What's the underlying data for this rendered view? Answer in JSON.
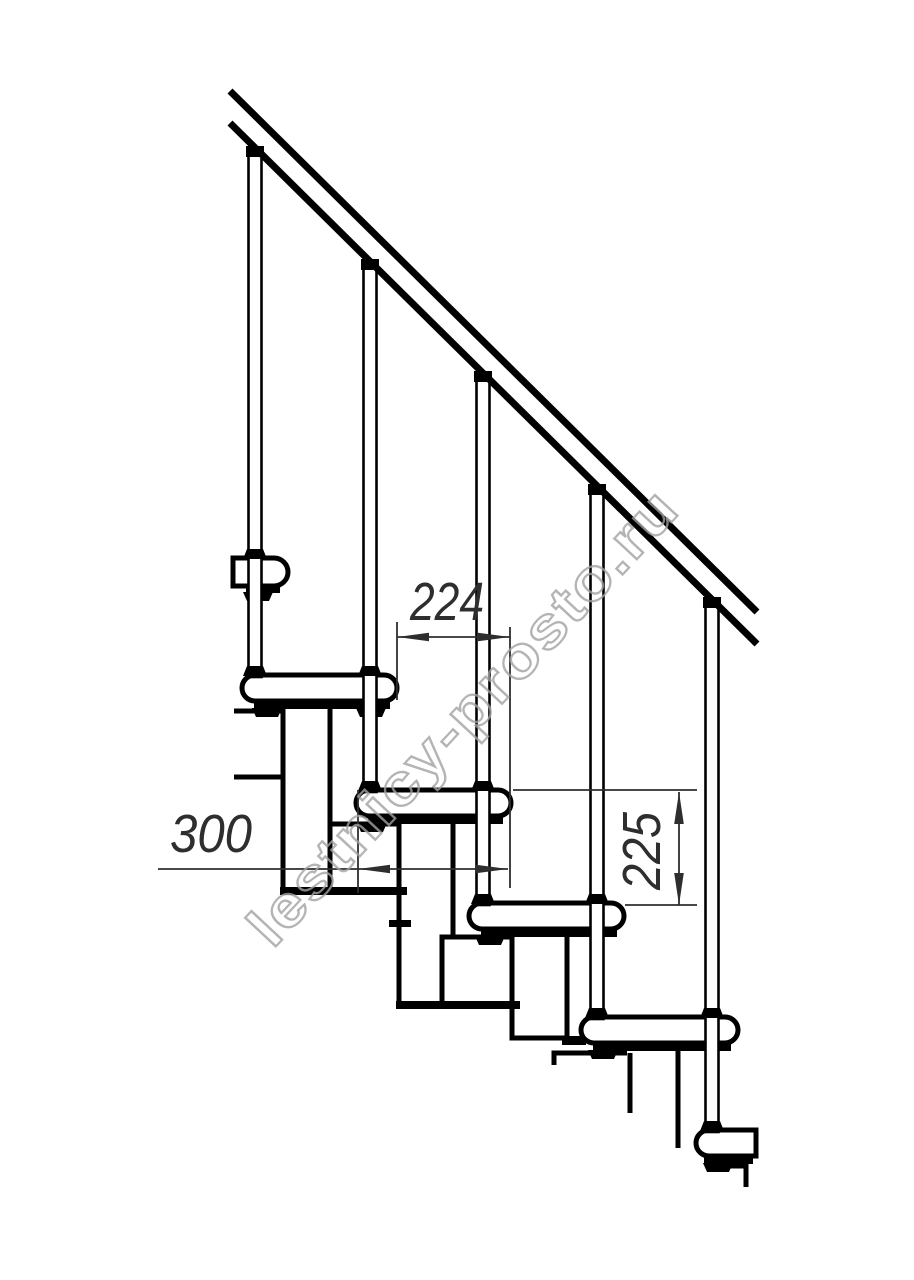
{
  "page": {
    "background": "#ffffff"
  },
  "drawing": {
    "line_color": "#000000",
    "dim_color": "#2e2e2e",
    "dimensions": {
      "step_run_224": {
        "value": "224"
      },
      "step_depth_300": {
        "value": "300"
      },
      "riser_height_225": {
        "value": "225"
      }
    },
    "watermark": {
      "text": "lestnicy-prosto.ru",
      "color": "#a2a2a2"
    },
    "components": {
      "handrail": 1,
      "balusters": 5,
      "treads": 6
    }
  }
}
